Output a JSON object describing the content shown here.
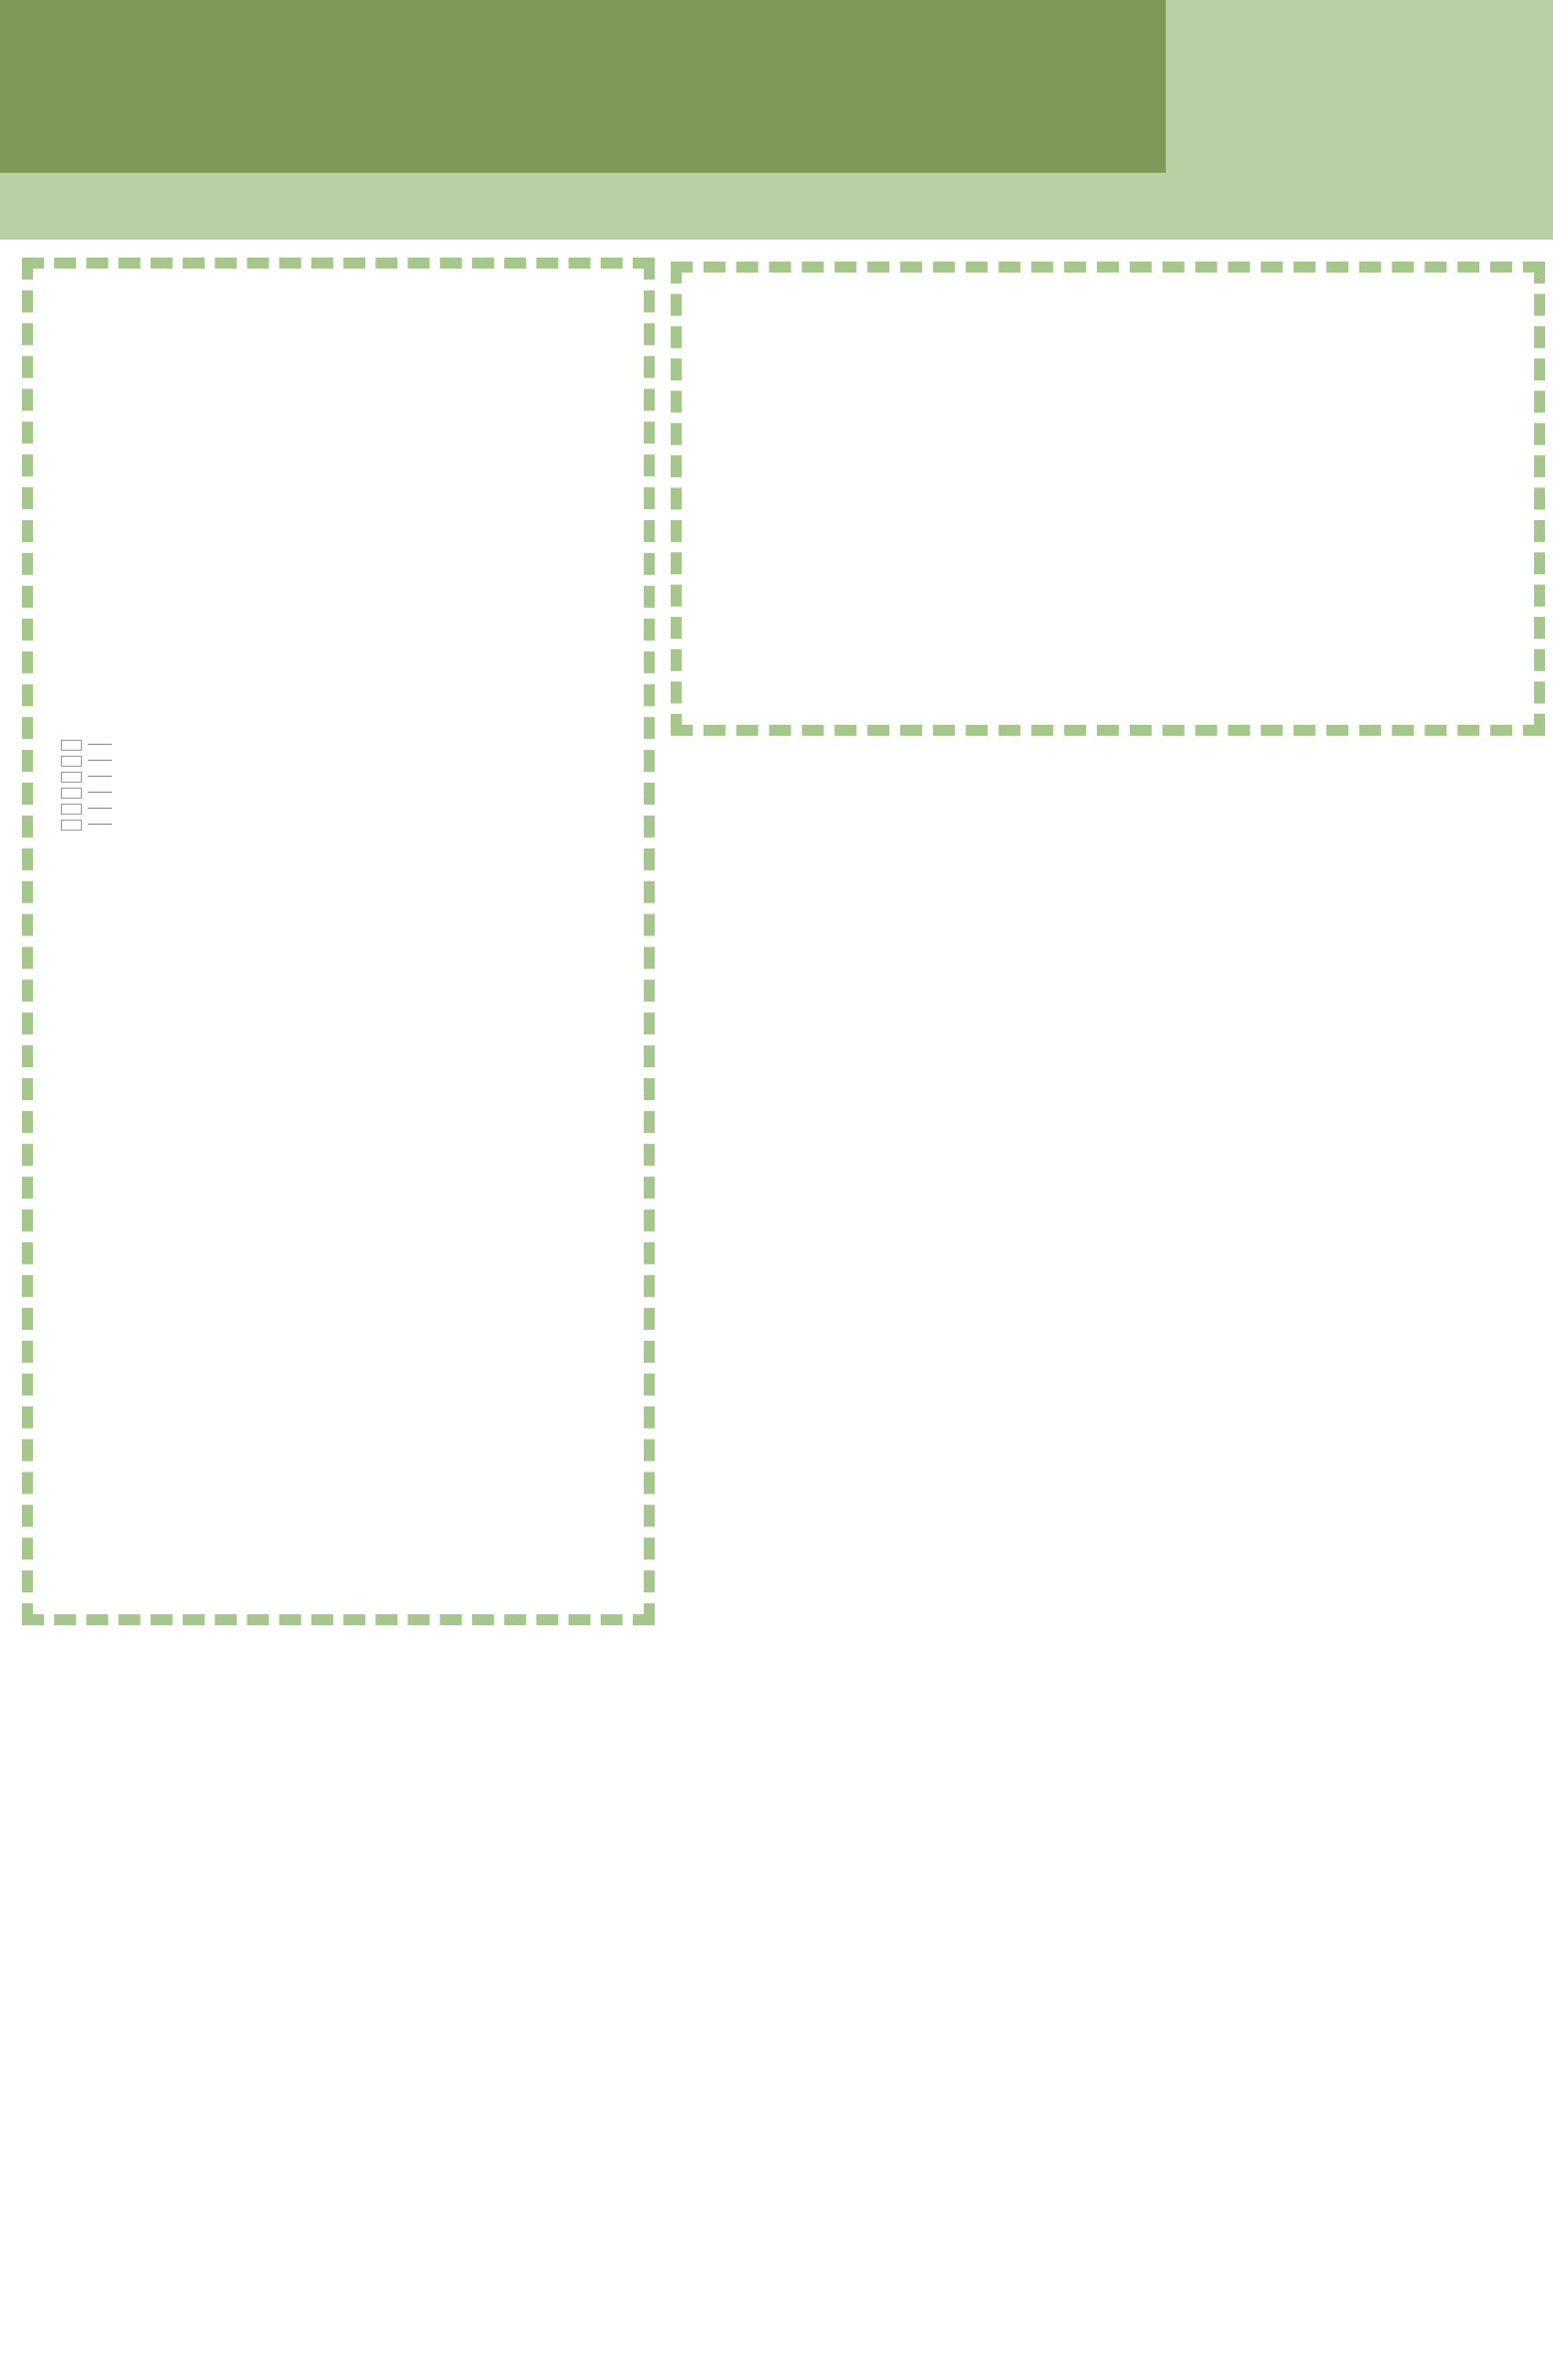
{
  "header": {
    "title": "渔文化特色小镇设计",
    "page_number": "05",
    "wave_icon": "wave-illustration",
    "colors": {
      "dark_green": "#7d9a58",
      "light_green": "#b7cfa2",
      "dash_green": "#a6c78b"
    }
  },
  "legend": {
    "items": [
      {
        "label": "办公空间",
        "color": "#c7b2d8"
      },
      {
        "label": "储藏空间",
        "color": "#8fcbe8"
      },
      {
        "label": "游览空间",
        "color": "#dd9494"
      },
      {
        "label": "休息空间",
        "color": "#c9a284"
      },
      {
        "label": "交通空间",
        "color": "#d4d4d4"
      },
      {
        "label": "活动空间",
        "color": "#cfe79d"
      }
    ]
  },
  "plans": [
    {
      "id": "plan1",
      "label": "一层平面",
      "scale": "1:200",
      "cols": [
        "1",
        "2",
        "3",
        "4",
        "5",
        "6",
        "7",
        "8",
        "9",
        "10",
        "11"
      ],
      "rows": [
        "L",
        "K",
        "J",
        "H",
        "G",
        "F",
        "E",
        "D",
        "C",
        "B",
        "A"
      ],
      "bay": "5000",
      "total": "50000"
    },
    {
      "id": "plan2",
      "label": "二层平面",
      "scale": "1:200",
      "cols": [
        "3",
        "4",
        "5",
        "6",
        "7",
        "8",
        "9"
      ],
      "rows": [
        "L",
        "K",
        "J",
        "H",
        "G",
        "F",
        "E",
        "D",
        "C",
        "B",
        "A"
      ],
      "bay": "5000",
      "total": "30000"
    },
    {
      "id": "plan3",
      "label": "三层平面",
      "scale": "1:200",
      "cols": [
        "5",
        "6",
        "7",
        "8",
        "9"
      ],
      "rows": [
        "L",
        "K",
        "J",
        "H",
        "G"
      ],
      "bay": "5000",
      "total": "20000"
    }
  ],
  "description": {
    "title": "渔文化展馆:",
    "paragraphs": [
      "展馆单体建筑设计中，汲取了江南建筑中“四水归堂”的理念;首层平面呈风车形，设计了三块室外展区和一大一小两块景观中庭。首层用简易分隔墙分隔出八个展区，有实物展区、数字展区、文字展区等，且设有一个最大的储藏空间。",
      "二层平面以外廊连接，内部分隔出六个展览房间及两大一小三个储藏空间。",
      "三层平面为正方形，其功能主要为办公。"
    ]
  },
  "drawings": {
    "section": {
      "label": "1-1剖面",
      "scale": "1:200"
    },
    "south_elevation": {
      "label": "南立面",
      "scale": "1:200"
    },
    "west_elevation": {
      "label": "西立面",
      "scale": "1:200"
    }
  }
}
